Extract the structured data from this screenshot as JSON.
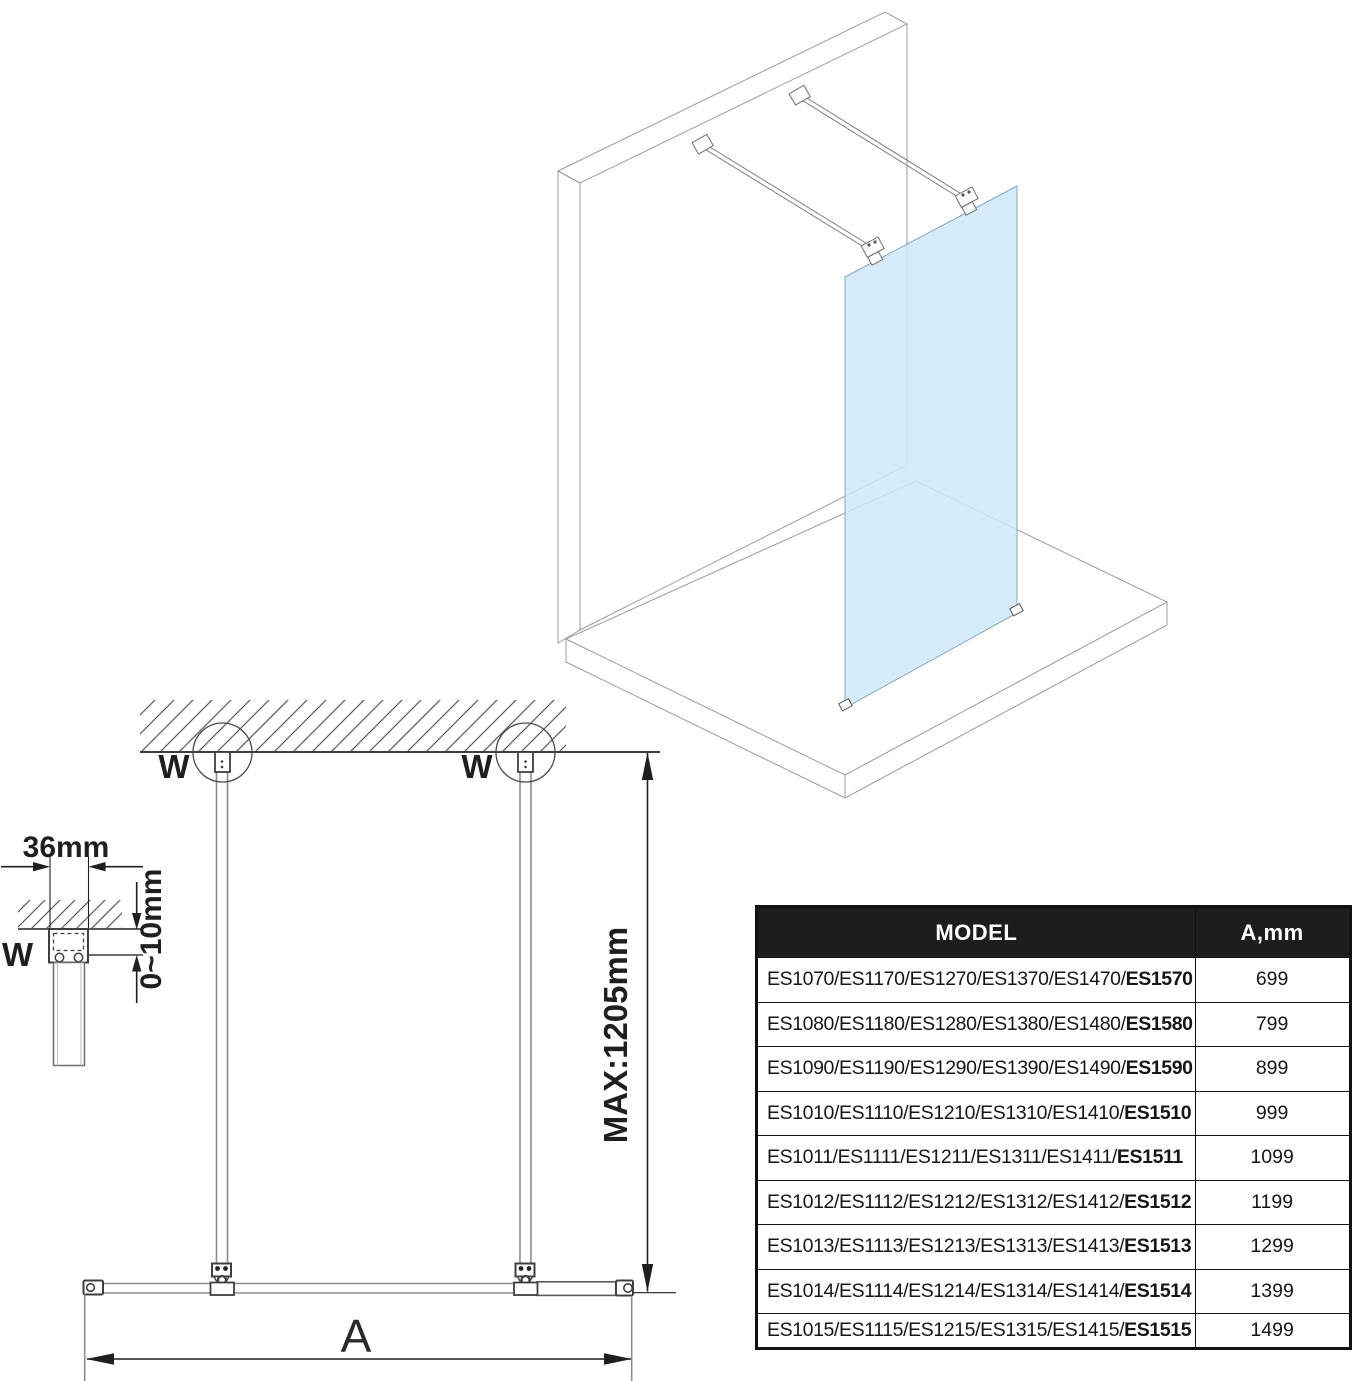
{
  "drawing": {
    "detail_marker": "W",
    "detail_width_label": "36mm",
    "detail_gap_label": "0~10mm",
    "max_height_label": "MAX:1205mm",
    "width_dim_label": "A"
  },
  "table": {
    "header": {
      "model": "MODEL",
      "a_mm": "A,mm"
    },
    "rows": [
      {
        "models": "ES1070/ES1170/ES1270/ES1370/ES1470/",
        "model_last": "ES1570",
        "a_mm": "699"
      },
      {
        "models": "ES1080/ES1180/ES1280/ES1380/ES1480/",
        "model_last": "ES1580",
        "a_mm": "799"
      },
      {
        "models": "ES1090/ES1190/ES1290/ES1390/ES1490/",
        "model_last": "ES1590",
        "a_mm": "899"
      },
      {
        "models": "ES1010/ES1110/ES1210/ES1310/ES1410/",
        "model_last": "ES1510",
        "a_mm": "999"
      },
      {
        "models": "ES1011/ES1111/ES1211/ES1311/ES1411/",
        "model_last": "ES1511",
        "a_mm": "1099"
      },
      {
        "models": "ES1012/ES1112/ES1212/ES1312/ES1412/",
        "model_last": "ES1512",
        "a_mm": "1199"
      },
      {
        "models": "ES1013/ES1113/ES1213/ES1313/ES1413/",
        "model_last": "ES1513",
        "a_mm": "1299"
      },
      {
        "models": "ES1014/ES1114/ES1214/ES1314/ES1414/",
        "model_last": "ES1514",
        "a_mm": "1399"
      },
      {
        "models": "ES1015/ES1115/ES1215/ES1315/ES1415/",
        "model_last": "ES1515",
        "a_mm": "1499"
      }
    ]
  },
  "colors": {
    "glass_fill": "#cfe8f8",
    "iso_line": "#9b9b9b",
    "drawing_line": "#3f3f3f",
    "dimension_line": "#1f1f1f",
    "table_border": "#111111",
    "table_header_bg": "#1d1d1d",
    "table_header_text": "#ffffff"
  }
}
